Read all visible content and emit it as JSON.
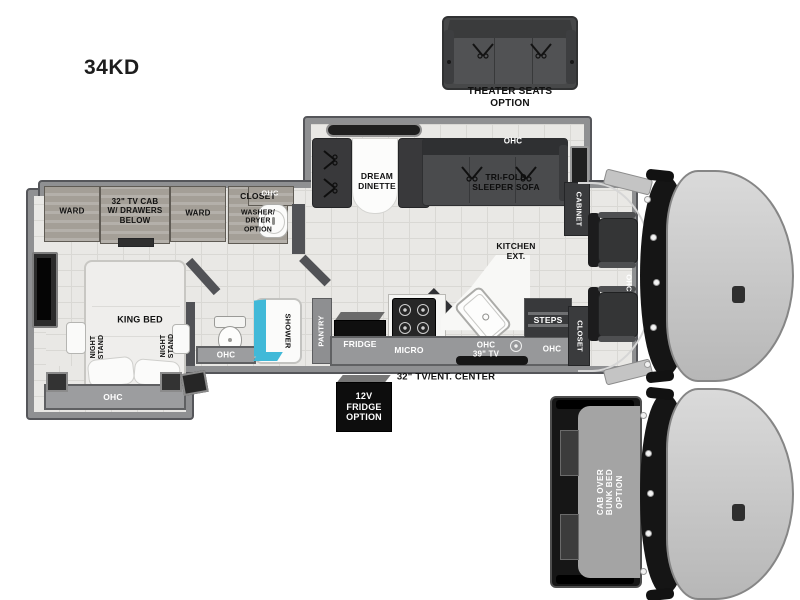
{
  "model": "34KD",
  "colors": {
    "accent_cyan": "#41b9d8",
    "wall_gray": "#8f9092",
    "floor_tile": "#e9e8e5",
    "furniture_dark": "#3a3b3d",
    "cab_body": "#c9c9c9",
    "label_black": "#111111",
    "label_white": "#ffffff"
  },
  "theater_option": {
    "label": "THEATER SEATS\nOPTION"
  },
  "top_slide": {
    "dinette_label": "DREAM\nDINETTE",
    "sofa_ohc_label": "OHC",
    "sofa_label": "TRI-FOLD\nSLEEPER SOFA"
  },
  "storage_row": {
    "ward_left": "WARD",
    "tv_cab": "32\" TV CAB\nW/ DRAWERS\nBELOW",
    "ward_right": "WARD",
    "closet": "CLOSET",
    "washer_dryer": "WASHER/\nDRYER\nOPTION",
    "vanity_ohc": "OHC"
  },
  "bedroom": {
    "bed_label": "KING BED",
    "night_stand_left": "NIGHT\nSTAND",
    "night_stand_right": "NIGHT\nSTAND",
    "ohc": "OHC"
  },
  "bath": {
    "ohc": "OHC",
    "shower": "SHOWER"
  },
  "kitchen": {
    "ext_label": "KITCHEN\nEXT.",
    "pantry": "PANTRY",
    "fridge": "FRIDGE",
    "micro": "MICRO",
    "ohc_tv": "OHC\n39\" TV",
    "steps": "STEPS",
    "entry_ohc": "OHC",
    "tv_center": "32\" TV/ENT. CENTER"
  },
  "cab": {
    "cabinet": "CABINET",
    "ohc": "OHC",
    "closet": "CLOSET"
  },
  "options": {
    "fridge_12v": "12V\nFRIDGE\nOPTION",
    "cab_over_bunk": "CAB OVER\nBUNK BED\nOPTION"
  }
}
